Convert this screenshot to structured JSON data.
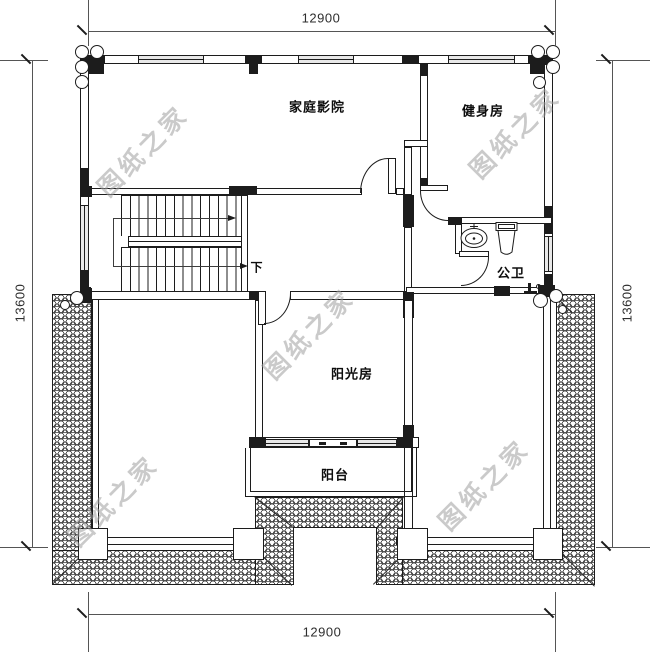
{
  "dimensions": {
    "top": "12900",
    "bottom": "12900",
    "left": "13600",
    "right": "13600"
  },
  "rooms": {
    "home_theater": "家庭影院",
    "gym": "健身房",
    "public_bathroom": "公卫",
    "sunroom": "阳光房",
    "balcony": "阳台"
  },
  "stairs": {
    "direction_label": "下"
  },
  "watermark": {
    "text": "图纸之家",
    "color": "#9f9f9f"
  },
  "colors": {
    "line": "#1c1c1c",
    "window_fill": "#e8e8e8",
    "background": "#ffffff"
  }
}
